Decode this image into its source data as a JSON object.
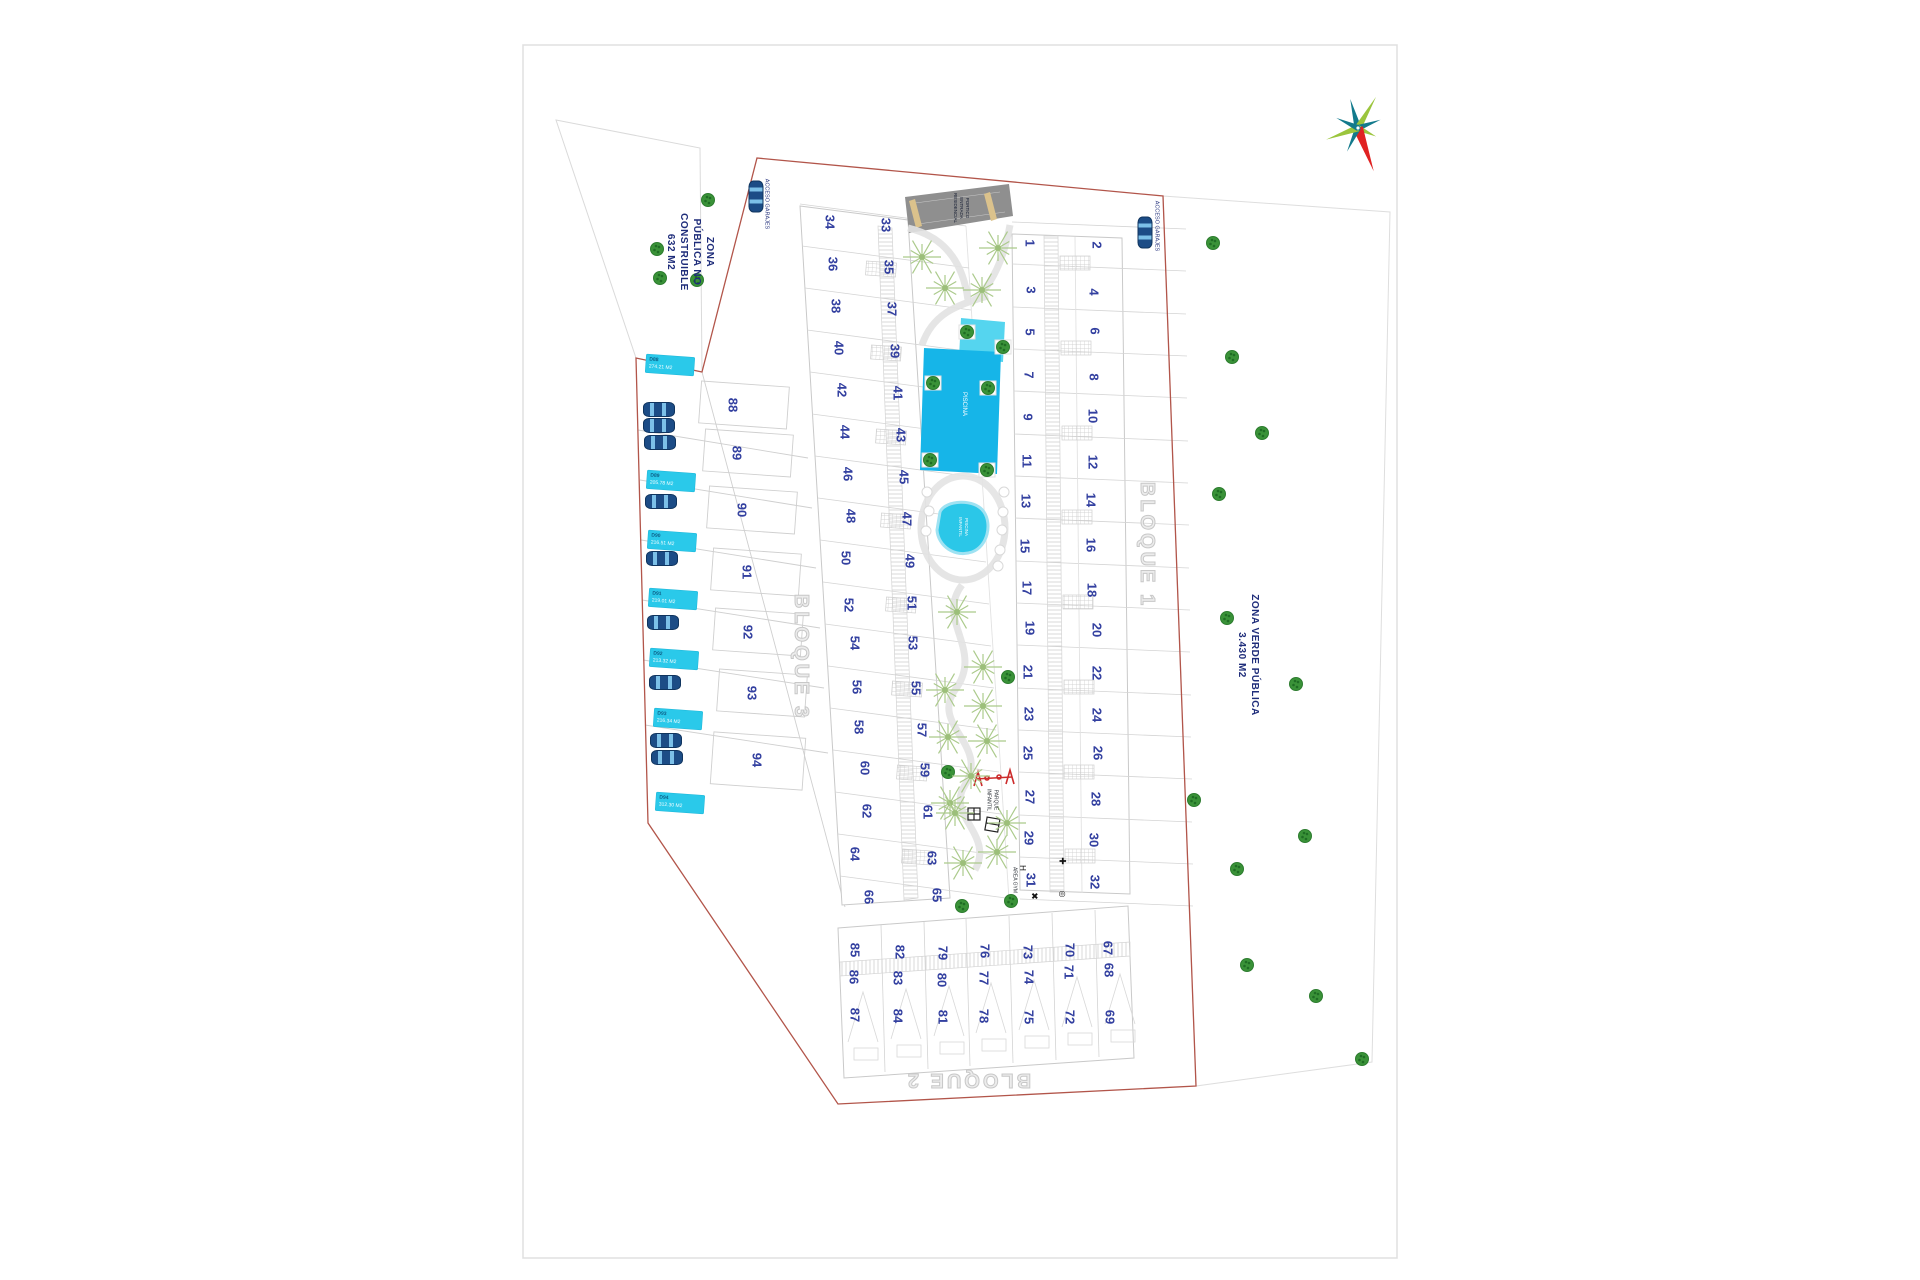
{
  "title": "Residential site plan",
  "colors": {
    "boundary_red": "#b2554a",
    "pool_cyan": "#16b5e8",
    "pool_light": "#55d5ef",
    "parking_label_cyan": "#2ac9ea",
    "plot_number_navy": "#3340a0",
    "tree_green": "#3a9238",
    "sketch_tree_green": "#abca8b",
    "ramp_grey": "#8f8f8f",
    "compass_red": "#e02222",
    "compass_teal": "#137a8c",
    "compass_green": "#9bc53d"
  },
  "zone_labels": [
    {
      "id": "zona-publica-no-construible",
      "lines": [
        "ZONA",
        "PÚBLICA NO",
        "CONSTRUIBLE",
        "632 M2"
      ],
      "x": 690,
      "y": 252,
      "rot": 90,
      "size": 10,
      "color": "#1f2d7a",
      "cls": "bold"
    },
    {
      "id": "zona-verde-publica",
      "lines": [
        "ZONA VERDE PÚBLICA",
        "3.430 M2"
      ],
      "x": 1248,
      "y": 655,
      "rot": 90,
      "size": 10,
      "color": "#1f2d7a",
      "cls": "bold"
    },
    {
      "id": "acceso-garajes-left",
      "lines": [
        "ACCESO GARAJES"
      ],
      "x": 766,
      "y": 204,
      "rot": 90,
      "size": 5.5,
      "color": "#1f2d7a",
      "cls": ""
    },
    {
      "id": "acceso-garajes-right",
      "lines": [
        "ACCESO GARAJES"
      ],
      "x": 1156,
      "y": 226,
      "rot": 90,
      "size": 5.5,
      "color": "#1f2d7a",
      "cls": ""
    },
    {
      "id": "portico-entrada",
      "lines": [
        "PORTICO",
        "ENTRADA",
        "RESIDENCIAL"
      ],
      "x": 961,
      "y": 208,
      "rot": 90,
      "size": 4.5,
      "color": "#10182e",
      "cls": ""
    },
    {
      "id": "piscina",
      "lines": [
        "PISCINA"
      ],
      "x": 963,
      "y": 404,
      "rot": 90,
      "size": 6,
      "color": "#ffffff",
      "cls": ""
    },
    {
      "id": "piscina-infantil",
      "lines": [
        "PISCINA",
        "INFANTIL"
      ],
      "x": 963,
      "y": 527,
      "rot": 90,
      "size": 4.5,
      "color": "#ffffff",
      "cls": ""
    },
    {
      "id": "parque-infantil",
      "lines": [
        "PARQUE",
        "INFANTIL"
      ],
      "x": 992,
      "y": 800,
      "rot": 90,
      "size": 5,
      "color": "#33383f",
      "cls": ""
    },
    {
      "id": "area-gym",
      "lines": [
        "AREA GYM"
      ],
      "x": 1014,
      "y": 880,
      "rot": 90,
      "size": 5,
      "color": "#33383f",
      "cls": ""
    },
    {
      "id": "bloque-1",
      "lines": [
        "BLOQUE 1"
      ],
      "x": 1147,
      "y": 545,
      "rot": 90,
      "size": 20,
      "color": "",
      "cls": "outline"
    },
    {
      "id": "bloque-3",
      "lines": [
        "BLOQUE 3"
      ],
      "x": 801,
      "y": 657,
      "rot": 90,
      "size": 20,
      "color": "",
      "cls": "outline"
    },
    {
      "id": "bloque-2",
      "lines": [
        "BLOQUE 2"
      ],
      "x": 968,
      "y": 1080,
      "rot": 180,
      "size": 20,
      "color": "",
      "cls": "outline"
    }
  ],
  "plots": [
    [
      1,
      1030,
      243
    ],
    [
      3,
      1031,
      290
    ],
    [
      5,
      1030,
      332
    ],
    [
      7,
      1029,
      375
    ],
    [
      9,
      1028,
      417
    ],
    [
      11,
      1027,
      461
    ],
    [
      13,
      1026,
      501
    ],
    [
      15,
      1025,
      546
    ],
    [
      17,
      1027,
      588
    ],
    [
      19,
      1030,
      628
    ],
    [
      21,
      1028,
      672
    ],
    [
      23,
      1029,
      714
    ],
    [
      25,
      1028,
      753
    ],
    [
      27,
      1030,
      797
    ],
    [
      29,
      1029,
      838
    ],
    [
      31,
      1031,
      880
    ],
    [
      2,
      1097,
      245
    ],
    [
      4,
      1094,
      292
    ],
    [
      6,
      1095,
      331
    ],
    [
      8,
      1094,
      377
    ],
    [
      10,
      1093,
      416
    ],
    [
      12,
      1093,
      462
    ],
    [
      14,
      1091,
      500
    ],
    [
      16,
      1091,
      545
    ],
    [
      18,
      1092,
      590
    ],
    [
      20,
      1097,
      630
    ],
    [
      22,
      1097,
      673
    ],
    [
      24,
      1097,
      715
    ],
    [
      26,
      1098,
      753
    ],
    [
      28,
      1096,
      799
    ],
    [
      30,
      1094,
      840
    ],
    [
      32,
      1095,
      882
    ],
    [
      34,
      830,
      222
    ],
    [
      36,
      833,
      264
    ],
    [
      38,
      836,
      306
    ],
    [
      40,
      839,
      348
    ],
    [
      42,
      842,
      390
    ],
    [
      44,
      845,
      432
    ],
    [
      46,
      848,
      474
    ],
    [
      48,
      851,
      516
    ],
    [
      50,
      846,
      558
    ],
    [
      52,
      849,
      605
    ],
    [
      54,
      855,
      643
    ],
    [
      56,
      857,
      687
    ],
    [
      58,
      859,
      727
    ],
    [
      60,
      865,
      768
    ],
    [
      62,
      867,
      811
    ],
    [
      64,
      855,
      854
    ],
    [
      66,
      869,
      897
    ],
    [
      33,
      886,
      225
    ],
    [
      35,
      889,
      267
    ],
    [
      37,
      892,
      309
    ],
    [
      39,
      895,
      351
    ],
    [
      41,
      898,
      393
    ],
    [
      43,
      901,
      435
    ],
    [
      45,
      904,
      477
    ],
    [
      47,
      907,
      519
    ],
    [
      49,
      910,
      561
    ],
    [
      51,
      912,
      603
    ],
    [
      53,
      913,
      643
    ],
    [
      55,
      916,
      688
    ],
    [
      57,
      922,
      730
    ],
    [
      59,
      925,
      770
    ],
    [
      61,
      928,
      812
    ],
    [
      63,
      932,
      858
    ],
    [
      65,
      937,
      895
    ],
    [
      85,
      855,
      950
    ],
    [
      86,
      854,
      977
    ],
    [
      87,
      855,
      1015
    ],
    [
      82,
      900,
      952
    ],
    [
      83,
      898,
      978
    ],
    [
      84,
      898,
      1016
    ],
    [
      79,
      943,
      953
    ],
    [
      80,
      942,
      980
    ],
    [
      81,
      943,
      1017
    ],
    [
      76,
      985,
      951
    ],
    [
      77,
      984,
      978
    ],
    [
      78,
      984,
      1016
    ],
    [
      73,
      1028,
      952
    ],
    [
      74,
      1029,
      977
    ],
    [
      75,
      1029,
      1017
    ],
    [
      70,
      1070,
      950
    ],
    [
      71,
      1069,
      972
    ],
    [
      72,
      1070,
      1017
    ],
    [
      67,
      1108,
      948
    ],
    [
      68,
      1109,
      970
    ],
    [
      69,
      1110,
      1017
    ],
    [
      88,
      733,
      405
    ],
    [
      89,
      737,
      453
    ],
    [
      90,
      742,
      510
    ],
    [
      91,
      747,
      572
    ],
    [
      92,
      748,
      632
    ],
    [
      93,
      752,
      693
    ],
    [
      94,
      757,
      760
    ]
  ],
  "parking_labels": [
    {
      "code": "D88",
      "area": "274.21 M2",
      "x": 646,
      "y": 356
    },
    {
      "code": "D89",
      "area": "205.78 M2",
      "x": 647,
      "y": 472
    },
    {
      "code": "D90",
      "area": "216.51 M2",
      "x": 648,
      "y": 532
    },
    {
      "code": "D91",
      "area": "219.01 M2",
      "x": 649,
      "y": 590
    },
    {
      "code": "D92",
      "area": "213.32 M2",
      "x": 650,
      "y": 650
    },
    {
      "code": "D93",
      "area": "216.34 M2",
      "x": 654,
      "y": 710
    },
    {
      "code": "D94",
      "area": "312.30 M2",
      "x": 656,
      "y": 794
    }
  ],
  "cars": [
    {
      "x": 658,
      "y": 408,
      "rot": 0
    },
    {
      "x": 658,
      "y": 424,
      "rot": 0
    },
    {
      "x": 659,
      "y": 441,
      "rot": 0
    },
    {
      "x": 660,
      "y": 500,
      "rot": 0
    },
    {
      "x": 661,
      "y": 557,
      "rot": 0
    },
    {
      "x": 662,
      "y": 621,
      "rot": 0
    },
    {
      "x": 664,
      "y": 681,
      "rot": 0
    },
    {
      "x": 665,
      "y": 739,
      "rot": 0
    },
    {
      "x": 666,
      "y": 756,
      "rot": 0
    },
    {
      "x": 755,
      "y": 195,
      "rot": 90
    },
    {
      "x": 1144,
      "y": 231,
      "rot": 90
    }
  ],
  "trees_small": [
    [
      708,
      200
    ],
    [
      657,
      249
    ],
    [
      660,
      278
    ],
    [
      697,
      280
    ],
    [
      1008,
      677
    ],
    [
      948,
      772
    ],
    [
      962,
      906
    ],
    [
      1011,
      901
    ],
    [
      1213,
      243
    ],
    [
      1232,
      357
    ],
    [
      1262,
      433
    ],
    [
      1219,
      494
    ],
    [
      1227,
      618
    ],
    [
      1296,
      684
    ],
    [
      1194,
      800
    ],
    [
      1237,
      869
    ],
    [
      1305,
      836
    ],
    [
      1247,
      965
    ],
    [
      1316,
      996
    ],
    [
      1362,
      1059
    ]
  ],
  "trees_pool": [
    [
      967,
      332
    ],
    [
      1003,
      347
    ],
    [
      933,
      383
    ],
    [
      988,
      388
    ],
    [
      930,
      460
    ],
    [
      987,
      470
    ]
  ],
  "trees_garden": [
    [
      922,
      257
    ],
    [
      998,
      248
    ],
    [
      945,
      288
    ],
    [
      982,
      290
    ],
    [
      957,
      612
    ],
    [
      983,
      667
    ],
    [
      945,
      690
    ],
    [
      983,
      706
    ],
    [
      948,
      737
    ],
    [
      987,
      741
    ],
    [
      971,
      776
    ],
    [
      950,
      803
    ],
    [
      997,
      852
    ],
    [
      963,
      863
    ],
    [
      1007,
      823
    ],
    [
      955,
      813
    ]
  ],
  "pond_circles": [
    [
      1004,
      492
    ],
    [
      1003,
      512
    ],
    [
      1002,
      530
    ],
    [
      1000,
      550
    ],
    [
      998,
      566
    ],
    [
      927,
      492
    ],
    [
      929,
      511
    ],
    [
      926,
      531
    ]
  ],
  "gym_icons": [
    {
      "glyph": "H",
      "x": 1022,
      "y": 868,
      "size": 8
    },
    {
      "glyph": "✚",
      "x": 1062,
      "y": 861,
      "size": 9
    },
    {
      "glyph": "✖",
      "x": 1034,
      "y": 896,
      "size": 9
    },
    {
      "glyph": "◎",
      "x": 1062,
      "y": 894,
      "size": 8
    }
  ]
}
